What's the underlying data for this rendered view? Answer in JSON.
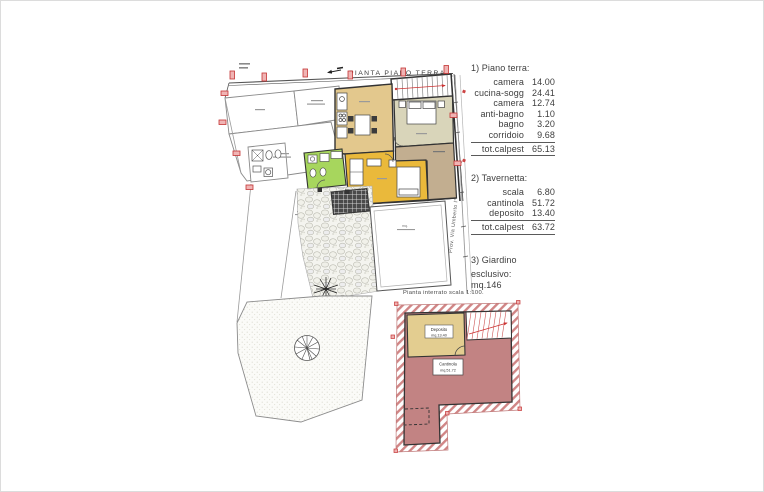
{
  "plan_top": {
    "title": "PIANTA PIANO TERRA",
    "street_label": "Prov. Via Umberto I°",
    "terrace_note": "mq."
  },
  "plan_basement": {
    "title": "Pianta interrato scala 1:100.",
    "deposito_label": "Deposito",
    "deposito_area": "mq.13.40",
    "cantinola_label": "Cantinola",
    "cantinola_area": "mq.51.72"
  },
  "legend": {
    "sections": [
      {
        "heading": "1) Piano terra:",
        "rows": [
          {
            "label": "camera",
            "value": "14.00"
          },
          {
            "label": "cucina-sogg",
            "value": "24.41"
          },
          {
            "label": "camera",
            "value": "12.74"
          },
          {
            "label": "anti-bagno",
            "value": "1.10"
          },
          {
            "label": "bagno",
            "value": "3.20"
          },
          {
            "label": "corridoio",
            "value": "9.68"
          }
        ],
        "total_label": "tot.calpest",
        "total_value": "65.13"
      },
      {
        "heading": "2) Tavernetta:",
        "rows": [
          {
            "label": "scala",
            "value": "6.80"
          },
          {
            "label": "cantinola",
            "value": "51.72"
          },
          {
            "label": "deposito",
            "value": "13.40"
          }
        ],
        "total_label": "tot.calpest",
        "total_value": "63.72"
      },
      {
        "heading": "3) Giardino",
        "lines": [
          "esclusivo:",
          "mq.146"
        ]
      }
    ]
  },
  "colors": {
    "kitchen_living": "#e3c88d",
    "bedroom1": "#d9d5ba",
    "corridor": "#c2ae90",
    "bedroom2": "#eab93b",
    "bathroom": "#a7d65d",
    "cantinola_floor": "#c28383",
    "deposito_floor": "#e3cd90",
    "wall_hatch": "#d08585",
    "marker_red": "#cc3333"
  }
}
